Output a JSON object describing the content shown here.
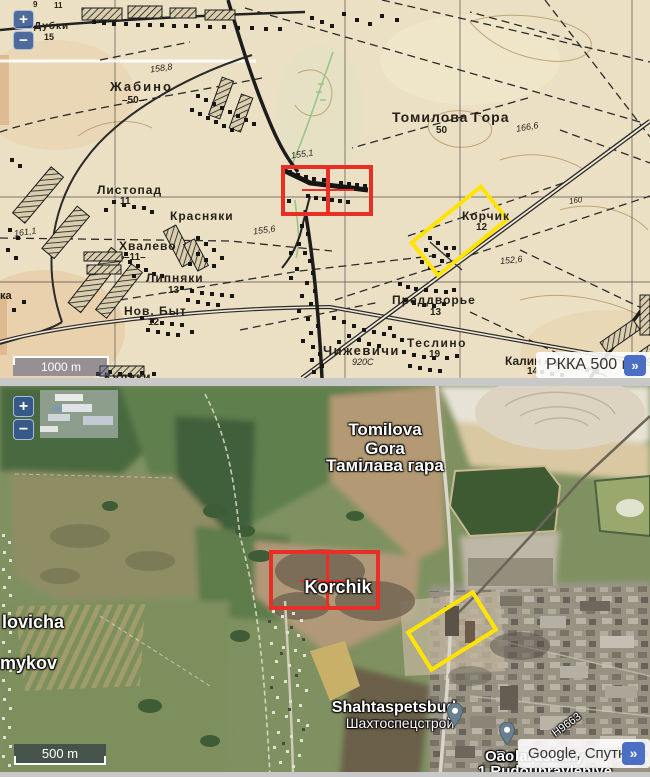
{
  "top_map": {
    "name": "RKKA topographic map panel",
    "zoom_in_label": "+",
    "zoom_out_label": "−",
    "scale_label": "1000 m",
    "attribution_label": "РККА 500 м",
    "attribution_expand": "»",
    "labels": [
      {
        "text": "Дубки",
        "x": 34,
        "y": 22,
        "size": 10,
        "sp": 1,
        "cls": "t"
      },
      {
        "text": "15",
        "x": 44,
        "y": 33,
        "size": 9,
        "cls": "t"
      },
      {
        "text": "9",
        "x": 33,
        "y": 1,
        "size": 8,
        "cls": "t"
      },
      {
        "text": "11",
        "x": 54,
        "y": 2,
        "size": 8,
        "cls": "t"
      },
      {
        "text": "Жабино",
        "x": 110,
        "y": 80,
        "size": 13,
        "sp": 2,
        "cls": "t"
      },
      {
        "text": "–50–",
        "x": 122,
        "y": 96,
        "size": 10,
        "cls": "t"
      },
      {
        "text": "158,8",
        "x": 150,
        "y": 64,
        "size": 9,
        "rot": -8,
        "cls": "t el"
      },
      {
        "text": "Томилова Гора",
        "x": 392,
        "y": 110,
        "size": 14,
        "sp": 1,
        "cls": "t"
      },
      {
        "text": "50",
        "x": 436,
        "y": 126,
        "size": 10,
        "cls": "t"
      },
      {
        "text": "166,6",
        "x": 516,
        "y": 123,
        "size": 9,
        "rot": -10,
        "cls": "t el"
      },
      {
        "text": "155,1",
        "x": 291,
        "y": 150,
        "size": 9,
        "rot": -8,
        "cls": "t el"
      },
      {
        "text": "160",
        "x": 569,
        "y": 197,
        "size": 8,
        "rot": -8,
        "cls": "t el"
      },
      {
        "text": "Листопад",
        "x": 97,
        "y": 184,
        "size": 12,
        "sp": 1,
        "cls": "t"
      },
      {
        "text": "11",
        "x": 120,
        "y": 197,
        "size": 10,
        "cls": "t"
      },
      {
        "text": "Красняки",
        "x": 170,
        "y": 210,
        "size": 12,
        "sp": 1,
        "cls": "t"
      },
      {
        "text": "Хвалево",
        "x": 119,
        "y": 240,
        "size": 12,
        "sp": 1,
        "cls": "t"
      },
      {
        "text": "–11–",
        "x": 124,
        "y": 253,
        "size": 10,
        "cls": "t"
      },
      {
        "text": "161,1",
        "x": 14,
        "y": 228,
        "size": 9,
        "rot": -8,
        "cls": "t el"
      },
      {
        "text": "155,6",
        "x": 253,
        "y": 226,
        "size": 9,
        "rot": -8,
        "cls": "t el"
      },
      {
        "text": "Липняки",
        "x": 146,
        "y": 272,
        "size": 12,
        "sp": 1,
        "cls": "t"
      },
      {
        "text": "13",
        "x": 168,
        "y": 286,
        "size": 10,
        "cls": "t"
      },
      {
        "text": "Нов. Быт",
        "x": 124,
        "y": 305,
        "size": 12,
        "sp": 1,
        "cls": "t"
      },
      {
        "text": "12",
        "x": 148,
        "y": 318,
        "size": 10,
        "cls": "t"
      },
      {
        "text": "Корчик",
        "x": 462,
        "y": 210,
        "size": 12,
        "sp": 1,
        "cls": "t"
      },
      {
        "text": "12",
        "x": 476,
        "y": 223,
        "size": 10,
        "cls": "t"
      },
      {
        "text": "152,6",
        "x": 500,
        "y": 256,
        "size": 9,
        "rot": -6,
        "cls": "t el"
      },
      {
        "text": "Преддворье",
        "x": 392,
        "y": 294,
        "size": 12,
        "sp": 1,
        "cls": "t"
      },
      {
        "text": "13",
        "x": 430,
        "y": 308,
        "size": 10,
        "cls": "t"
      },
      {
        "text": "Теслино",
        "x": 407,
        "y": 337,
        "size": 12,
        "sp": 1.5,
        "cls": "t"
      },
      {
        "text": "19",
        "x": 429,
        "y": 350,
        "size": 10,
        "cls": "t"
      },
      {
        "text": "Чижевичи",
        "x": 323,
        "y": 344,
        "size": 13,
        "sp": 1.5,
        "cls": "t"
      },
      {
        "text": "920С",
        "x": 352,
        "y": 358,
        "size": 9,
        "cls": "t el"
      },
      {
        "text": "Калин",
        "x": 505,
        "y": 355,
        "size": 12,
        "cls": "t"
      },
      {
        "text": "14",
        "x": 527,
        "y": 367,
        "size": 10,
        "cls": "t"
      },
      {
        "text": "Кулаки",
        "x": 104,
        "y": 371,
        "size": 12,
        "sp": 1,
        "cls": "t"
      },
      {
        "text": "ка",
        "x": 0,
        "y": 291,
        "size": 11,
        "cls": "t"
      }
    ]
  },
  "bottom_map": {
    "name": "Google satellite panel",
    "zoom_in_label": "+",
    "zoom_out_label": "−",
    "scale_label": "500 m",
    "attribution_label": "Google, Спутник",
    "attribution_expand": "»",
    "labels": [
      {
        "text": "Tomilova",
        "cx": 385,
        "y": 421,
        "size": 17,
        "cls": "s"
      },
      {
        "text": "Gora",
        "cx": 385,
        "y": 440,
        "size": 17,
        "cls": "s"
      },
      {
        "text": "Тамілава гара",
        "cx": 385,
        "y": 457,
        "size": 17,
        "cls": "s"
      },
      {
        "text": "Korchik",
        "cx": 338,
        "y": 578,
        "size": 18,
        "cls": "s"
      },
      {
        "text": "lovicha",
        "x": 2,
        "y": 613,
        "size": 18,
        "cls": "s"
      },
      {
        "text": "mykov",
        "x": 0,
        "y": 654,
        "size": 18,
        "cls": "s"
      },
      {
        "text": "Shahtaspetsbud",
        "cx": 394,
        "y": 700,
        "size": 16,
        "cls": "s"
      },
      {
        "text": "Шахтоспецстрой",
        "cx": 400,
        "y": 716,
        "size": 14,
        "cls": "s sm"
      },
      {
        "text": "Belaruskaliy",
        "cx": 540,
        "y": 749,
        "size": 15,
        "cls": "s"
      },
      {
        "text": "Оао",
        "x": 485,
        "y": 749,
        "size": 15,
        "cls": "s"
      },
      {
        "text": "1 Rudoupravleniye",
        "cx": 545,
        "y": 764,
        "size": 15,
        "cls": "s"
      },
      {
        "text": "Н9663",
        "cx": 567,
        "y": 720,
        "size": 11,
        "rot": -36,
        "cls": "s sm"
      }
    ]
  },
  "overlays": {
    "marker_color": "#e82f25",
    "highlight_color": "#ffe400"
  }
}
